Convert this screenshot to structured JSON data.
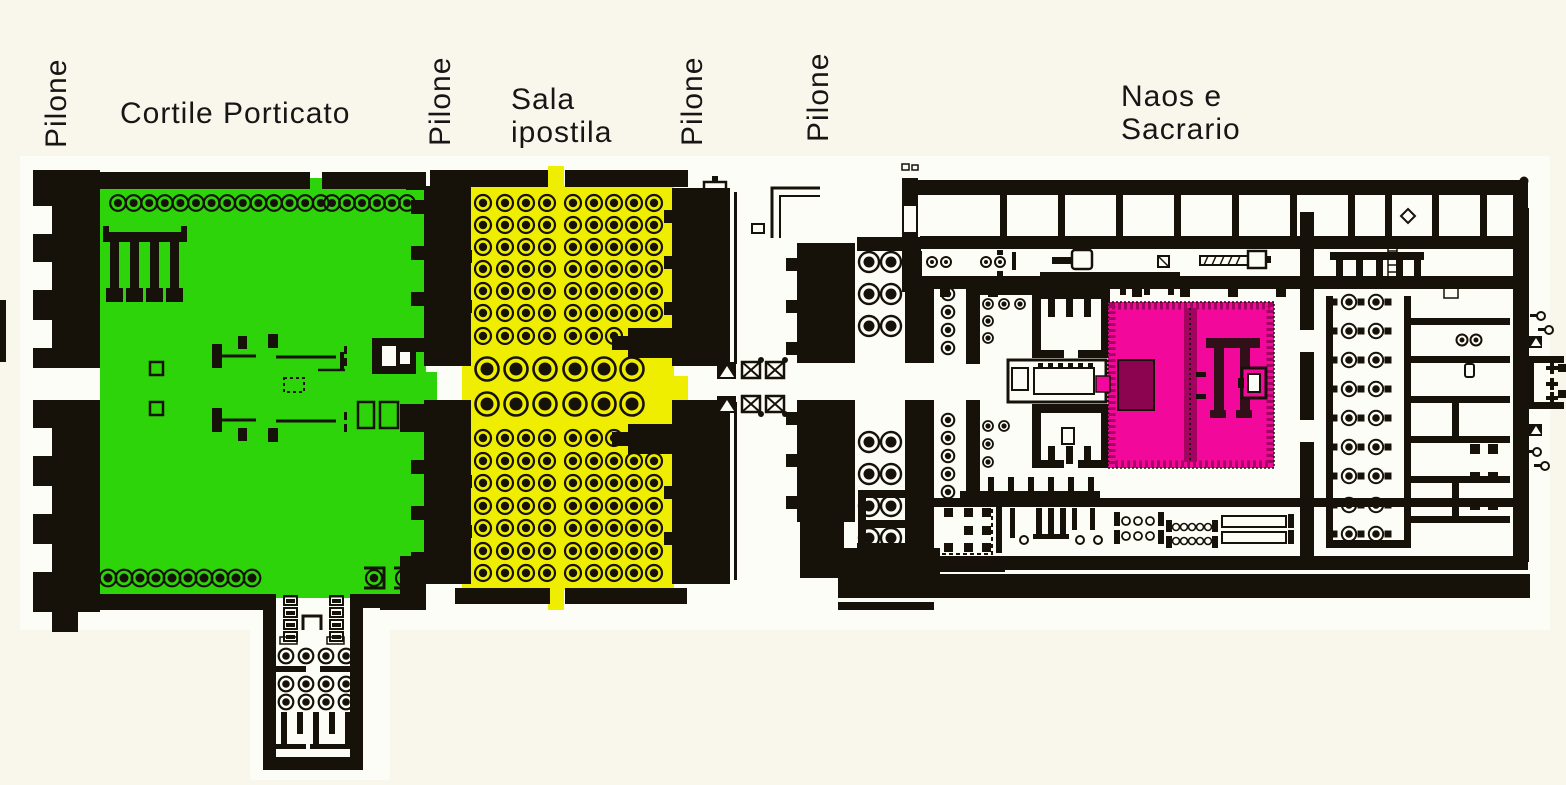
{
  "labels": {
    "pilone_1": "Pilone",
    "cortile": "Cortile Porticato",
    "pilone_2": "Pilone",
    "sala_line1": "Sala",
    "sala_line2": "ipostila",
    "pilone_3": "Pilone",
    "pilone_4": "Pilone",
    "naos_line1": "Naos e",
    "naos_line2": "Sacrario"
  },
  "areas": [
    {
      "label": "Cortile Porticato",
      "color": "#2ed40a"
    },
    {
      "label": "Sala ipostila",
      "color": "#f0ee00"
    },
    {
      "label": "Naos e Sacrario",
      "color": "#f2089a"
    },
    {
      "label": "Pilone",
      "color": "#171209"
    }
  ],
  "colors": {
    "paper": "#f9f7ec",
    "plan_paper": "#fdfdf8",
    "ink": "#171209",
    "courtyard": "#2ed40a",
    "hypostyle": "#f0ee00",
    "naos": "#f2089a",
    "naos_dark": "#a30361"
  }
}
